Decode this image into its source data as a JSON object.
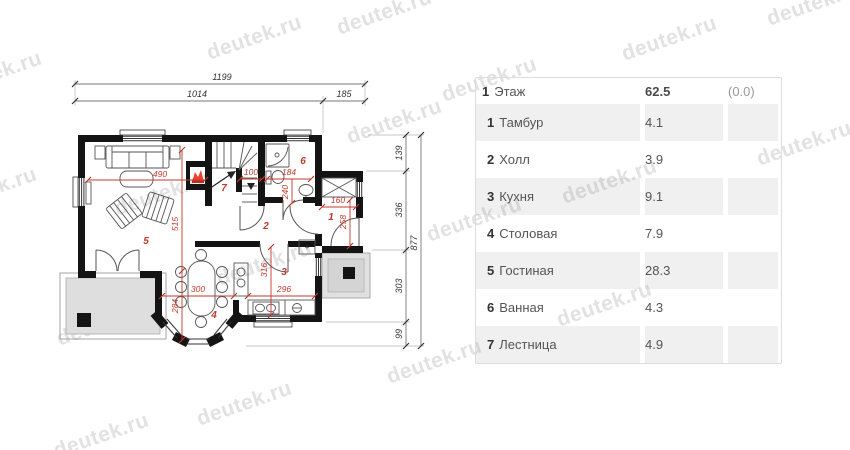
{
  "watermark": {
    "text": "deutek.ru",
    "color": "#e2e2e2"
  },
  "colors": {
    "wall": "#141414",
    "dimension_red": "#c0392b",
    "terrace_fill": "#dedede",
    "row_alt": "#f1f1f1",
    "flame_accent": "#e8432e"
  },
  "plan": {
    "outer_dims": {
      "total_width": "1199",
      "width_main": "1014",
      "width_entry": "185",
      "total_height": "877",
      "h1": "139",
      "h2": "336",
      "h3": "303",
      "h4": "99"
    },
    "inner_dims": {
      "living_w": "490",
      "living_h": "515",
      "stair_w": "100",
      "bath_w": "184",
      "bath_h": "240",
      "entry_w": "160",
      "entry_h": "258",
      "kitchen_h": "316",
      "kitchen_w": "296",
      "dining_w": "300",
      "dining_h": "284"
    },
    "rooms": {
      "r1": "1",
      "r2": "2",
      "r3": "3",
      "r4": "4",
      "r5": "5",
      "r6": "6",
      "r7": "7"
    },
    "kitchen_plus": "+"
  },
  "table": {
    "header": {
      "num": "1",
      "label": "Этаж",
      "area": "62.5",
      "extra": "(0.0)"
    },
    "rows": [
      {
        "num": "1",
        "name": "Тамбур",
        "area": "4.1"
      },
      {
        "num": "2",
        "name": "Холл",
        "area": "3.9"
      },
      {
        "num": "3",
        "name": "Кухня",
        "area": "9.1"
      },
      {
        "num": "4",
        "name": "Столовая",
        "area": "7.9"
      },
      {
        "num": "5",
        "name": "Гостиная",
        "area": "28.3"
      },
      {
        "num": "6",
        "name": "Ванная",
        "area": "4.3"
      },
      {
        "num": "7",
        "name": "Лестница",
        "area": "4.9"
      }
    ]
  }
}
